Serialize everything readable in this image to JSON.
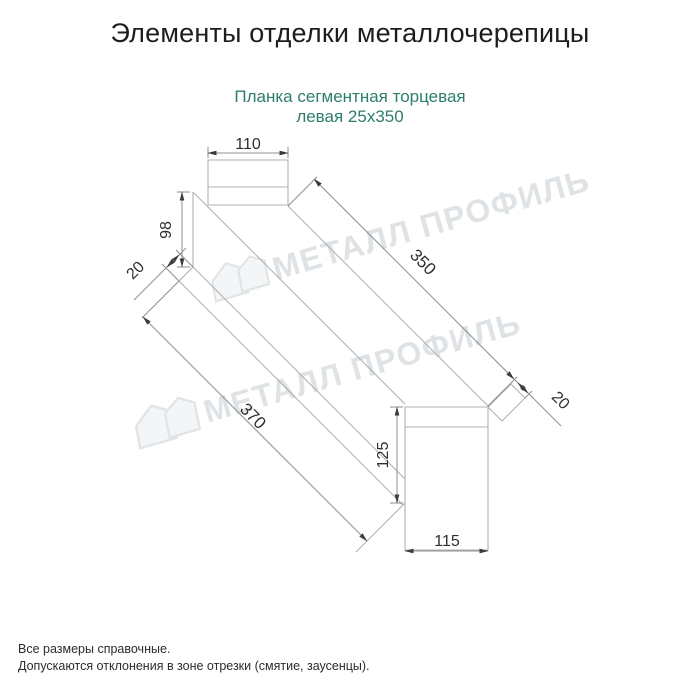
{
  "header": {
    "title": "Элементы отделки металлочерепицы"
  },
  "product": {
    "name_line1": "Планка сегментная торцевая",
    "name_line2": "левая 25х350"
  },
  "drawing": {
    "watermark_text": "МЕТАЛЛ ПРОФИЛЬ",
    "dimensions": {
      "top_width": "110",
      "left_face_height": "98",
      "left_flange": "20",
      "length_top": "350",
      "length_bottom": "370",
      "right_flange": "20",
      "right_face_height": "125",
      "bottom_width": "115"
    }
  },
  "footer": {
    "note1": "Все размеры справочные.",
    "note2": "Допускаются отклонения в зоне отрезки (смятие, заусенцы)."
  },
  "colors": {
    "accent_teal": "#2e7d6c",
    "geometry_line": "#aeb2b5",
    "dimension_line": "#8b8f92",
    "arrow": "#3a3d40",
    "dimension_text": "#2e2e2e",
    "watermark": "#dfe3e5"
  }
}
